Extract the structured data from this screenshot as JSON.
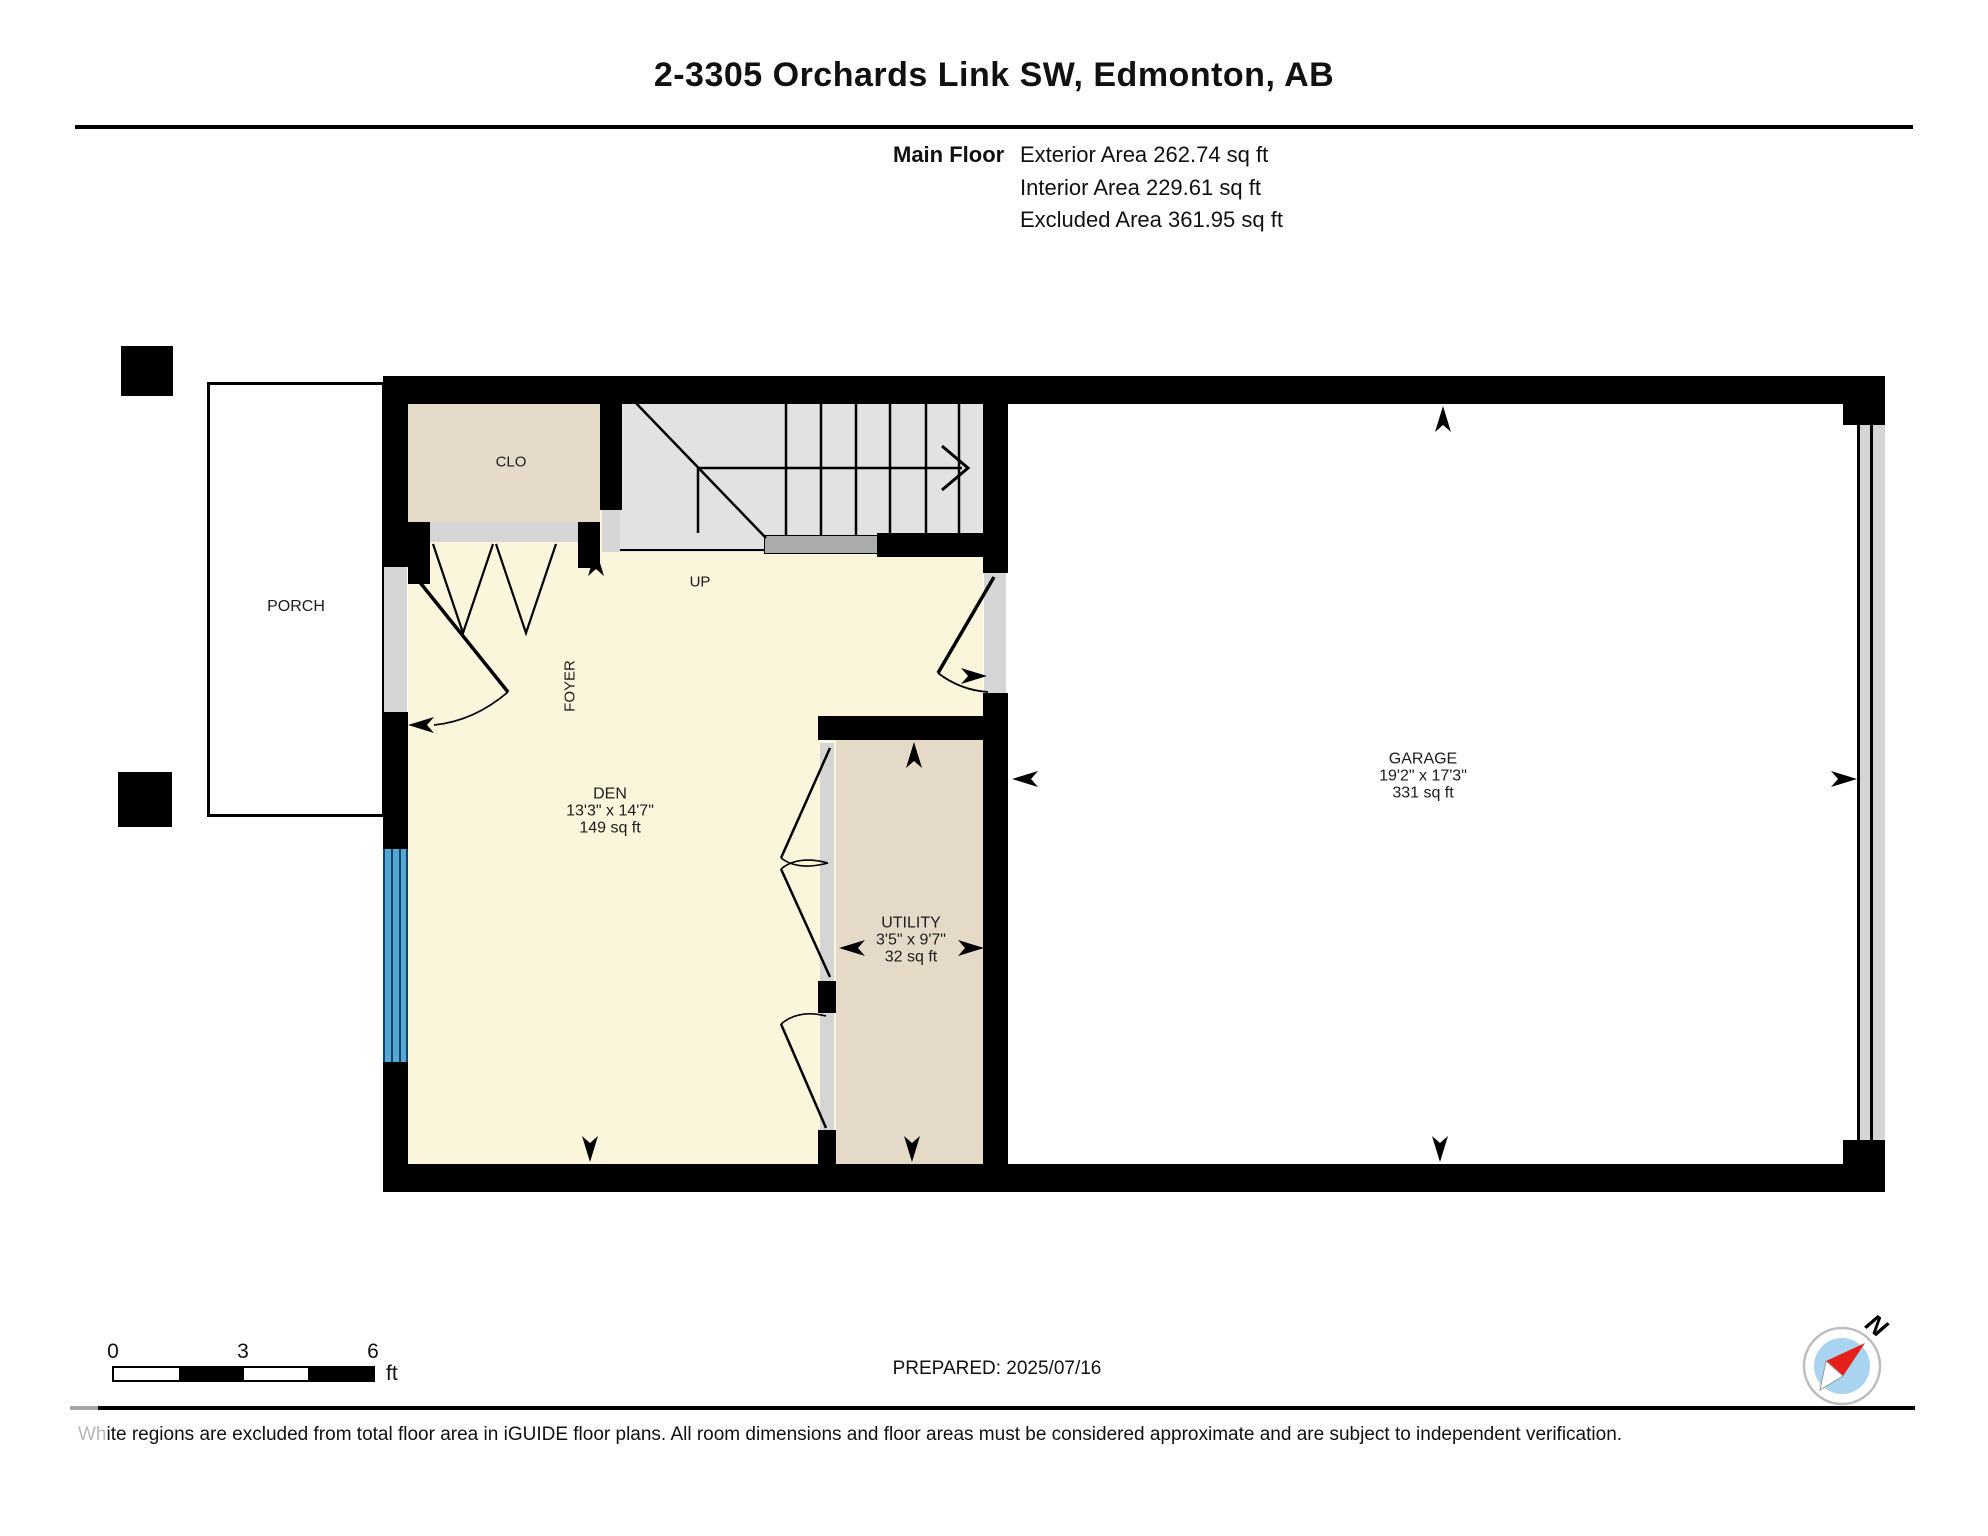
{
  "header": {
    "title": "2-3305 Orchards Link SW, Edmonton, AB",
    "floor_label": "Main Floor",
    "area_lines": [
      "Exterior Area 262.74 sq ft",
      "Interior Area 229.61 sq ft",
      "Excluded Area 361.95 sq ft"
    ]
  },
  "labels": {
    "porch": "PORCH",
    "closet": "CLO",
    "foyer": "FOYER",
    "up": "UP"
  },
  "rooms": {
    "den": {
      "name": "DEN",
      "dims": "13'3\" x 14'7\"",
      "area": "149 sq ft"
    },
    "utility": {
      "name": "UTILITY",
      "dims": "3'5\" x 9'7\"",
      "area": "32 sq ft"
    },
    "garage": {
      "name": "GARAGE",
      "dims": "19'2\" x 17'3\"",
      "area": "331 sq ft"
    }
  },
  "footer": {
    "scale_ticks": [
      "0",
      "3",
      "6"
    ],
    "scale_unit": "ft",
    "prepared": "PREPARED: 2025/07/16",
    "disclaimer_lead": "Wh",
    "disclaimer_rest": "ite regions are excluded from total floor area in iGUIDE floor plans. All room dimensions and floor areas must be considered approximate and are subject to independent verification.",
    "compass_north": "N"
  },
  "colors": {
    "wall": "#000000",
    "floor-cream": "#FBF5DC",
    "room-tan": "#E5DAC7",
    "stair-gray": "#E2E2E2",
    "jamb-gray": "#D5D5D5",
    "landing-gray": "#ABABAB",
    "window-blue": "#55A8D4",
    "window-line": "#12436B",
    "compass-inner": "#A9D4F1",
    "compass-needle": "#E32119"
  }
}
